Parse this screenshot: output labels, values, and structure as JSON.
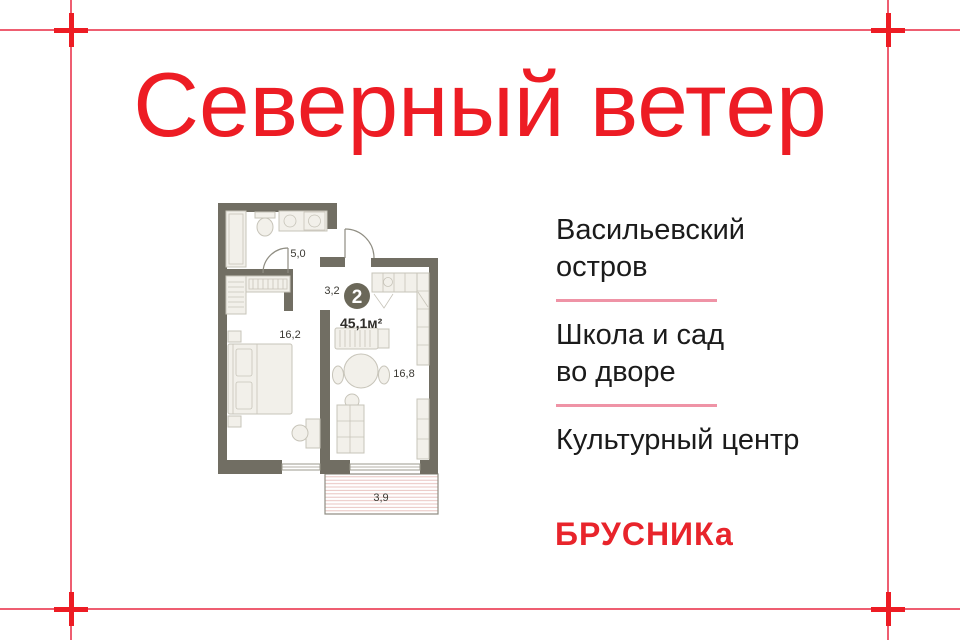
{
  "title": {
    "text": "Северный ветер",
    "color": "#ed1c24"
  },
  "features": {
    "text_color": "#1b1b1b",
    "divider_color": "#ef93a6",
    "items": [
      {
        "lines": [
          "Васильевский",
          "остров"
        ]
      },
      {
        "lines": [
          "Школа и сад",
          "во дворе"
        ]
      },
      {
        "lines": [
          "Культурный центр"
        ]
      }
    ]
  },
  "logo": {
    "text": "БРУСНИКа",
    "color": "#e8242b"
  },
  "floorplan": {
    "badge": {
      "rooms_count": "2",
      "total_area": "45,1м²",
      "circle_color": "#6b6859"
    },
    "room_labels": {
      "bathroom": "5,0",
      "hallway": "3,2",
      "bedroom": "16,2",
      "living_kitchen": "16,8",
      "balcony": "3,9"
    },
    "wall_color": "#716e63"
  },
  "crop_marks": {
    "line_color": "#ee5e71",
    "cross_color": "#ed1c24"
  }
}
